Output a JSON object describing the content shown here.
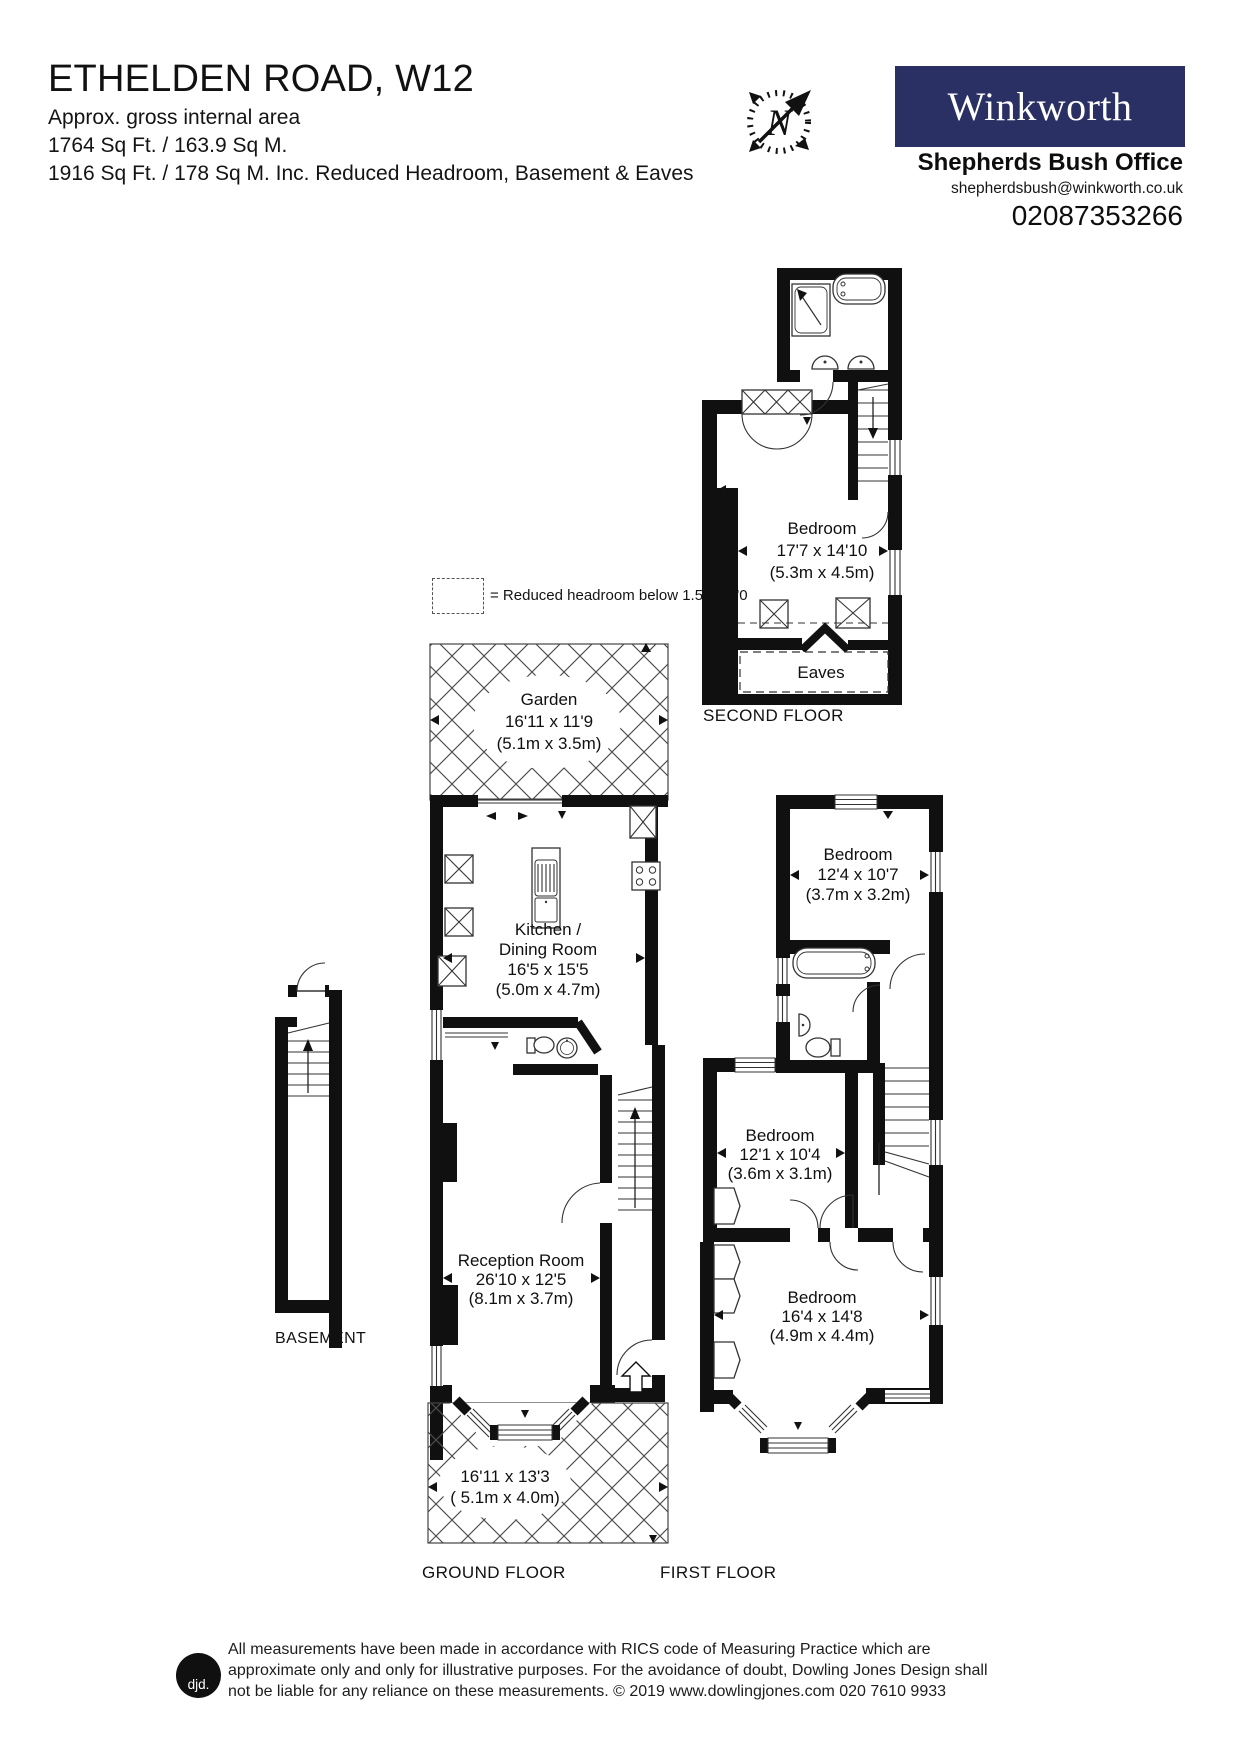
{
  "page": {
    "paper": "#ffffff",
    "ink": "#111111"
  },
  "header": {
    "title": "ETHELDEN ROAD, W12",
    "subtitle": "Approx. gross internal area",
    "area_line1": "1764 Sq Ft. / 163.9 Sq M.",
    "area_line2": "1916 Sq Ft. / 178 Sq M. Inc. Reduced Headroom, Basement & Eaves",
    "compass_n": "N",
    "agency": {
      "brand": "Winkworth",
      "brand_bg": "#2a3063",
      "office": "Shepherds Bush Office",
      "email": "shepherdsbush@winkworth.co.uk",
      "phone": "02087353266"
    }
  },
  "legend": {
    "reduced_headroom": "= Reduced headroom below 1.5m / 5'0"
  },
  "floors": {
    "second": {
      "label": "SECOND FLOOR",
      "bedroom": {
        "name": "Bedroom",
        "imperial": "17'7 x 14'10",
        "metric": "(5.3m x 4.5m)"
      },
      "eaves": "Eaves"
    },
    "first": {
      "label": "FIRST FLOOR",
      "bedroom_rear": {
        "name": "Bedroom",
        "imperial": "12'4 x 10'7",
        "metric": "(3.7m x 3.2m)"
      },
      "bedroom_middle": {
        "name": "Bedroom",
        "imperial": "12'1 x 10'4",
        "metric": "(3.6m x 3.1m)"
      },
      "bedroom_front": {
        "name": "Bedroom",
        "imperial": "16'4 x 14'8",
        "metric": "(4.9m x 4.4m)"
      }
    },
    "ground": {
      "label": "GROUND FLOOR",
      "garden": {
        "name": "Garden",
        "imperial": "16'11 x 11'9",
        "metric": "(5.1m x 3.5m)"
      },
      "kitchen": {
        "name_line1": "Kitchen /",
        "name_line2": "Dining Room",
        "imperial": "16'5 x 15'5",
        "metric": "(5.0m x 4.7m)"
      },
      "reception": {
        "name": "Reception Room",
        "imperial": "26'10 x 12'5",
        "metric": "(8.1m x 3.7m)"
      },
      "front_garden": {
        "imperial": "16'11 x 13'3",
        "metric": "( 5.1m x 4.0m)"
      }
    },
    "basement": {
      "label": "BASEMENT"
    }
  },
  "footer": {
    "logo": "djd.",
    "line1": "All measurements have been made in accordance with RICS code of Measuring Practice which are",
    "line2": "approximate only and only for illustrative purposes. For the avoidance of doubt, Dowling Jones Design shall",
    "line3": "not be liable for any reliance on these measurements. © 2019 www.dowlingjones.com 020 7610 9933"
  },
  "icons": {
    "compass": "ticked ring with italic N and NE needle arrow",
    "bathtub": "rounded rectangle tub",
    "shower": "square tray with corner arrow",
    "basin": "round / half-round basin",
    "toilet": "pan with cistern",
    "hob": "four burner rings",
    "stairs": "parallel treads with direction arrow",
    "door": "quarter-circle swing",
    "window": "triple parallel lines",
    "skylight": "box with X",
    "wardrobe": "box with X rail / chevron front",
    "entrance": "hollow up arrow",
    "garden_hatch": "diagonal crosshatch paving"
  }
}
